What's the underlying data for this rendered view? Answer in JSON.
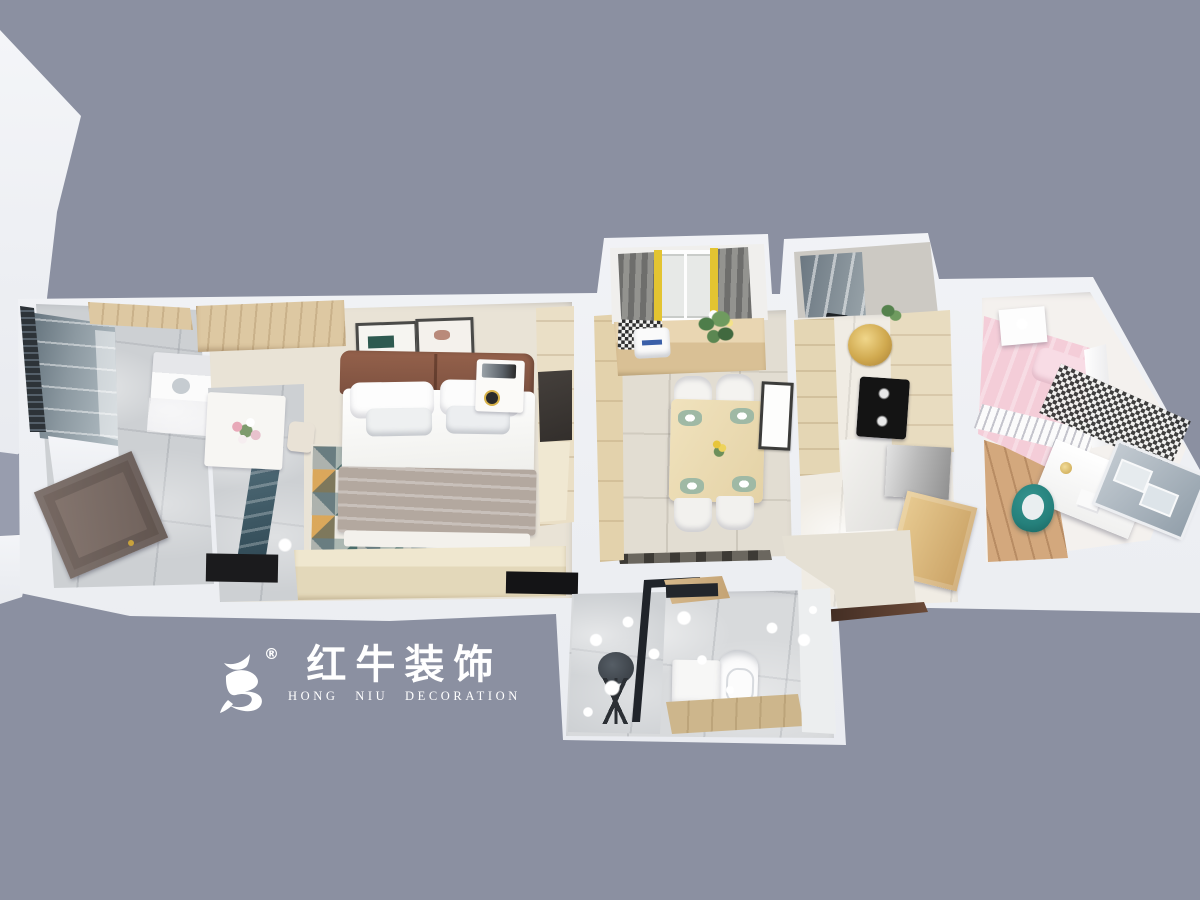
{
  "scene": {
    "kind": "3d-floorplan-dollhouse-render",
    "rooms_depicted": [
      "laundry-balcony",
      "master-bedroom",
      "entry",
      "dining-room",
      "dining-balcony",
      "kitchen",
      "kids-bedroom",
      "bathroom"
    ]
  },
  "watermark": {
    "logo_icon": "bull-swoosh-icon",
    "registered_mark": "®",
    "title_cn": "红牛装饰",
    "subtitle_en": "HONG NIU DECORATION"
  },
  "palette": {
    "bg": "#8b90a1",
    "wall": "#f2f3f7",
    "floorBeige": "#e2ddd2",
    "bedroomFloor": "#e9e3d6",
    "marble": "#cdd0d3",
    "marbleDark": "#3f5a66",
    "woodLight": "#ddc8a2",
    "woodMid": "#d0ab79",
    "oakFloor": "#d3a87d",
    "headboard": "#8a5a46",
    "blanketGray": "#b3a89f",
    "rugTeal": "#39605f",
    "rugMustard": "#d9a14e",
    "rugSlate": "#7b8a8c",
    "rugCream": "#efede6",
    "pink": "#f4cdd8",
    "tealChair": "#25807b",
    "cooktop": "#141414",
    "fridgeSilver": "#b5b5b5",
    "doorBrown": "#7c6e66",
    "curtainGray": "#7d7d7b",
    "curtainYellow": "#e3c431",
    "logoWhite": "#ffffff"
  }
}
